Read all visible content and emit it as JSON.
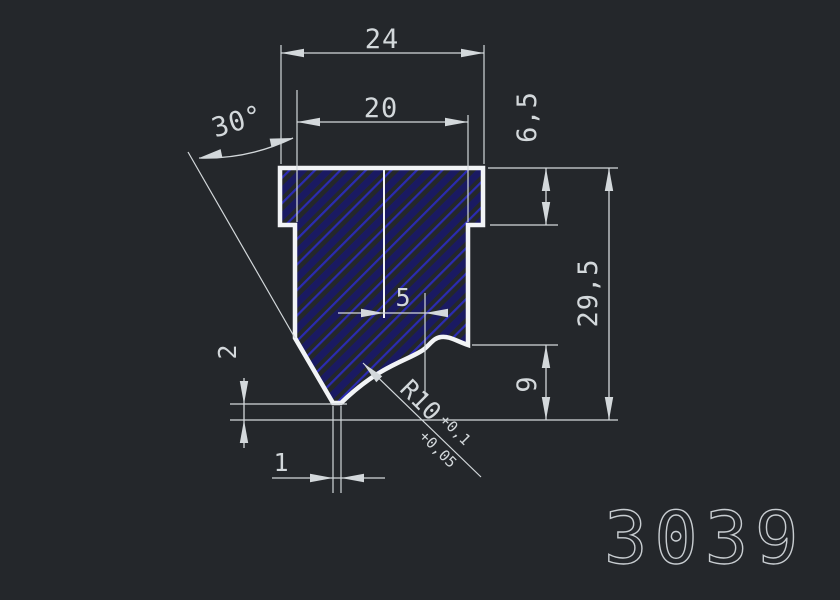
{
  "drawing": {
    "part_number": "3039",
    "dimensions": {
      "outer_width": "24",
      "inner_width": "20",
      "flange_height": "6,5",
      "total_height": "29,5",
      "right_height": "9",
      "tip_offset": "5",
      "tip_height": "2",
      "tip_width": "1",
      "angle": "30°",
      "radius": "R10",
      "radius_tol_upper": "+0,1",
      "radius_tol_lower": "+0,05"
    },
    "colors": {
      "background": "#24272b",
      "line": "#d3d8db",
      "outline": "#f2f4f6",
      "hatch_line": "#2b2bb2",
      "hatch_band": "#1a1a62"
    }
  }
}
